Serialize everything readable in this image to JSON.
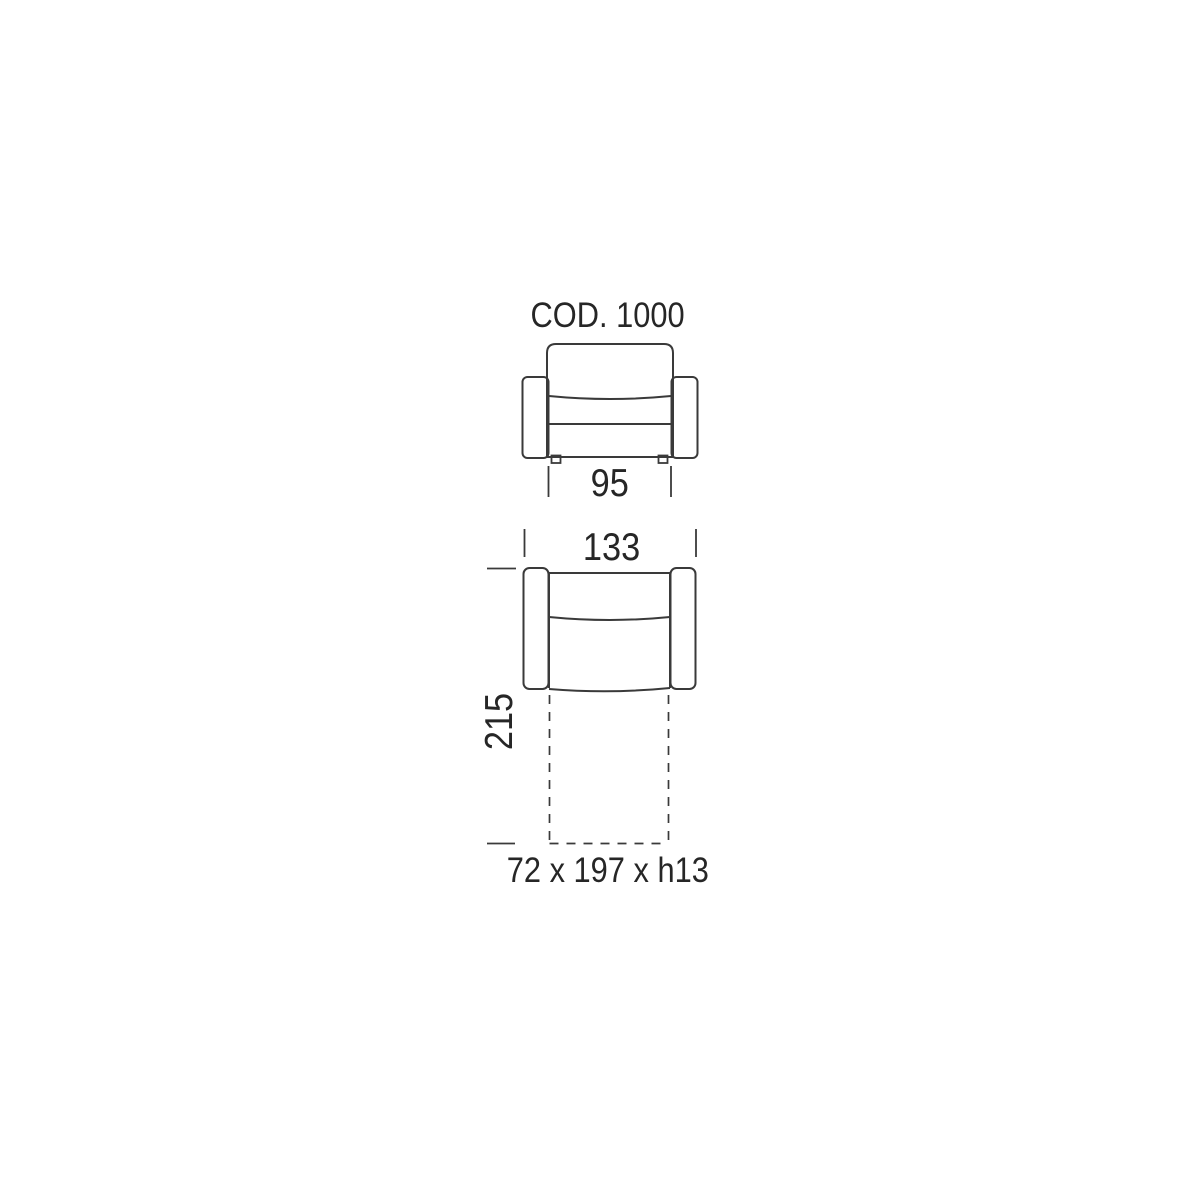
{
  "diagram": {
    "title": "COD. 1000",
    "front_view": {
      "width_dimension": "95"
    },
    "top_view": {
      "width_dimension": "133",
      "depth_dimension": "215",
      "pullout_bed_dimension": "72 x 197 x h13"
    },
    "colors": {
      "line": "#3a3a3a",
      "text": "#262626",
      "background": "#ffffff"
    }
  }
}
